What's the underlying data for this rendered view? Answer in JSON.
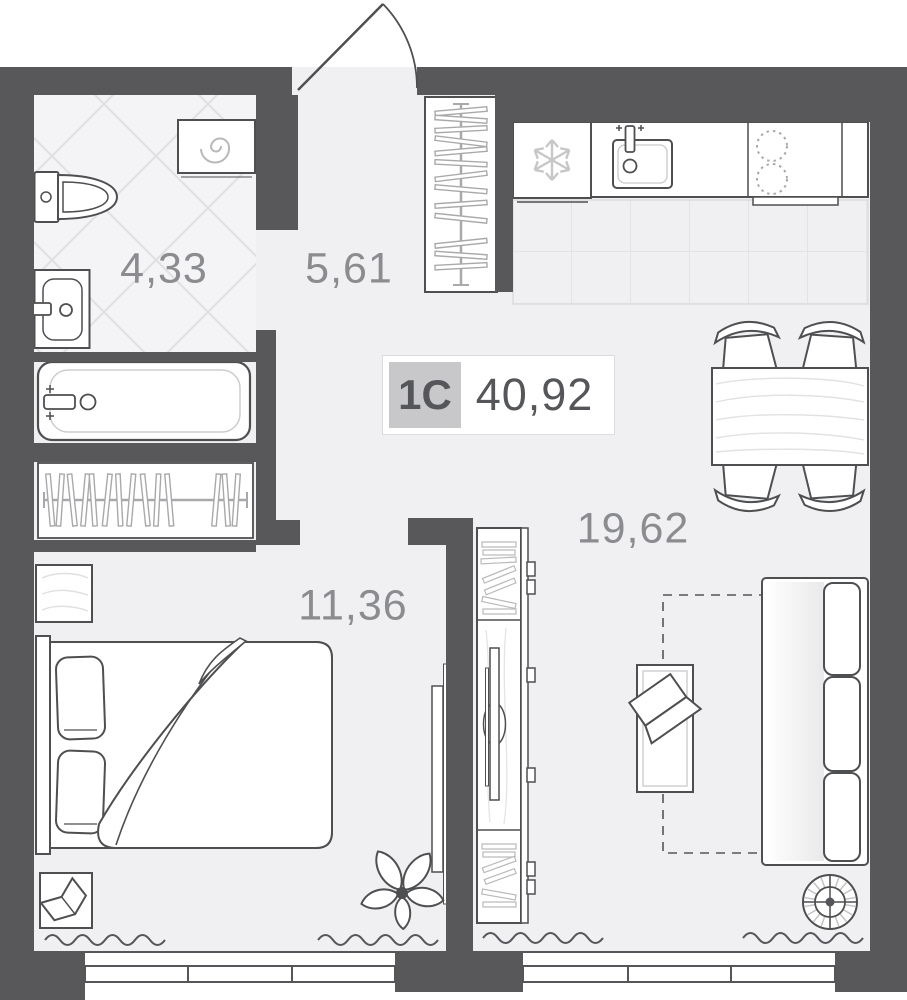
{
  "badge": {
    "unit_type": "1C",
    "total_area": "40,92"
  },
  "room_areas": {
    "bathroom": "4,33",
    "hallway": "5,61",
    "bedroom": "11,36",
    "living_kitchen": "19,62"
  },
  "icons": {
    "fridge": "snowflake-icon",
    "washing_machine": "spiral-drum-icon",
    "floor_lamp": "radial-lamp-icon"
  },
  "colors": {
    "wall": "#58585a",
    "floor": "#f0f0f2",
    "outline_dark": "#4e4f51",
    "outline_light": "#b9b9bb",
    "tile_line": "#e0e0e2",
    "label_text": "#8b8c8f",
    "badge_bg": "#c8c8ca",
    "badge_text": "#55565a"
  }
}
